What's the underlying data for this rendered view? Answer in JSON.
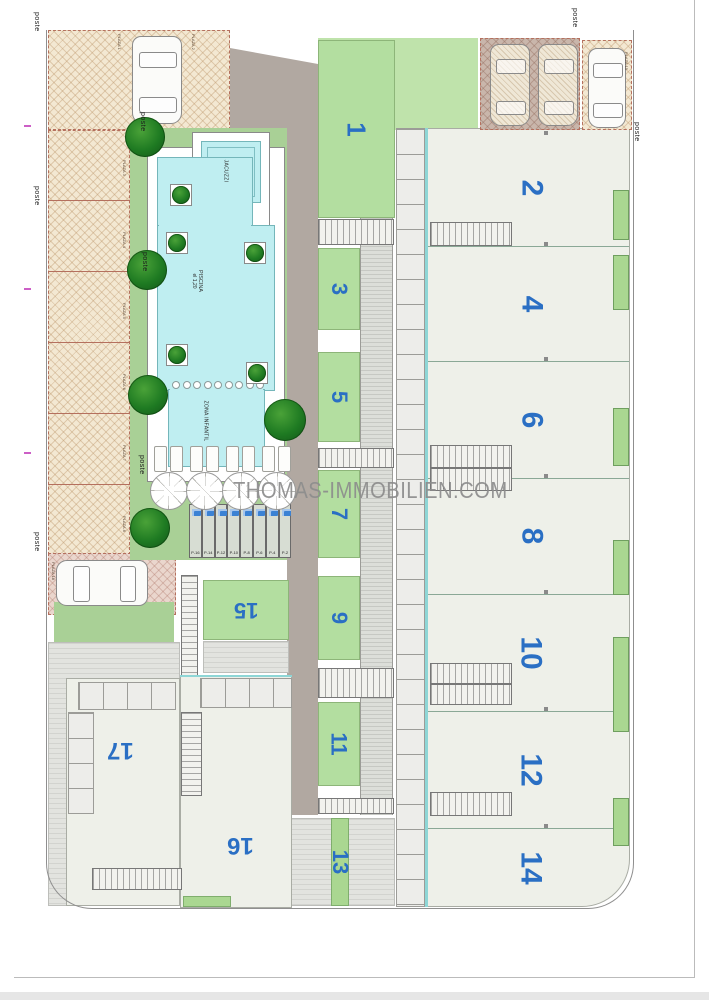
{
  "watermark": {
    "text": "THOMAS-IMMOBILIEN.COM"
  },
  "pool": {
    "jacuzzi_label": "JACUZZI",
    "piscina_label": "PISCINA",
    "depth_label": "el 1,20",
    "kids_label": "ZONA INFANTIL"
  },
  "units": {
    "odd": [
      "1",
      "3",
      "5",
      "7",
      "9",
      "11",
      "13"
    ],
    "even": [
      "2",
      "4",
      "6",
      "8",
      "10",
      "12",
      "14"
    ],
    "lower": [
      "15",
      "16",
      "17"
    ]
  },
  "parking_spaces": [
    "P-16",
    "P-14",
    "P-12",
    "P-10",
    "P-8",
    "P-6",
    "P-4",
    "P-2"
  ],
  "post_label": "poste",
  "plaza_labels": [
    "PLAZA 1",
    "PLAZA 2",
    "PLAZA 3",
    "PLAZA 4",
    "PLAZA 5",
    "PLAZA 6",
    "PLAZA 7",
    "PLAZA 8",
    "PLAZA 15",
    "PLAZA 18"
  ],
  "colors": {
    "unit_number_blue": "#2a6fc4",
    "garden_green": "#a9d096",
    "terrace_green": "#b3dea0",
    "pool_cyan": "#bfeef1",
    "canopy_beige": "#f3e8d2",
    "canopy_mauve": "#c9b6ab",
    "road_taupe": "#b1a8a1",
    "watermark_gray": "#8d8d8d",
    "hedge_green": "#aad791"
  }
}
